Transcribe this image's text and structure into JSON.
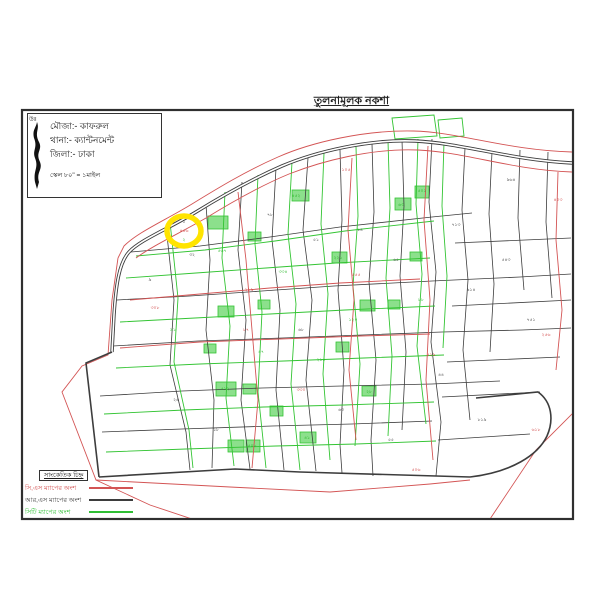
{
  "header": {
    "title": "তুলনামূলক নকশা"
  },
  "info_box": {
    "north_label": "উঃ",
    "mouza": "মৌজা:- কাফরুল",
    "thana": "থানা:- ক্যান্টনমেন্ট",
    "zila": "জিলা:- ঢাকা",
    "scale": "স্কেল ৮০\" = ১মাইল"
  },
  "legend": {
    "title": "সাংকেতিক চিহ্ন",
    "entries": [
      {
        "label": "সি,এস ম্যাপের অংশ",
        "color": "#d35454"
      },
      {
        "label": "আর,এস ম্যাপের অংশ",
        "color": "#3d3d3d"
      },
      {
        "label": "সিটি ম্যাপের অংশ",
        "color": "#2fbf35"
      }
    ]
  },
  "map": {
    "colors": {
      "frame": "#2f2f2f",
      "rs_black": "#3d3d3d",
      "cs_red": "#d35454",
      "city_green": "#33c433",
      "fill_green": "#8ce08c",
      "label_green": "#1db31d",
      "label_red": "#cc3333",
      "label_black": "#333333",
      "highlight_yellow": "#ffe400"
    },
    "frame": {
      "x": 22,
      "y": 110,
      "w": 551,
      "h": 409
    },
    "highlight": {
      "cx": 184,
      "cy": 231,
      "rx": 17,
      "ry": 15,
      "w": 5.5
    },
    "roads": [
      {
        "d": "M 572,163 C 510,160 462,143 415,141 C 368,139 315,152 282,166 C 250,180 222,196 196,212 C 168,229 140,240 129,252 C 119,263 116,285 114,315 L 112,352",
        "w": 3.4
      },
      {
        "d": "M 112,352 L 86,363 L 99,477",
        "w": 1.6
      },
      {
        "d": "M 99,477 L 235,469 L 300,472 L 470,477",
        "w": 1.6
      },
      {
        "d": "M 470,477 C 512,472 538,455 547,436 C 554,420 552,402 538,392 L 476,398",
        "w": 1.6
      }
    ],
    "rs_lines": [
      "M 166,226 L 174,300 L 170,365 L 186,432 L 190,470",
      "M 206,205 L 210,260 L 206,330 L 214,400 L 212,468",
      "M 242,182 L 238,250 L 246,320 L 241,400 L 250,469",
      "M 276,168 L 272,240 L 280,310 L 276,390 L 284,470",
      "M 308,158 L 303,230 L 312,300 L 306,380 L 316,471",
      "M 340,150 L 342,220 L 338,290 L 344,370 L 340,445 L 342,473",
      "M 372,144 L 374,212 L 369,282 L 376,360 L 371,440 L 373,476",
      "M 402,140 L 404,206 L 400,276 L 406,352 L 402,430",
      "M 432,139 L 429,202 L 436,272 L 431,342 L 441,422 L 436,476",
      "M 465,148 L 462,210 L 468,280 L 463,350 L 470,420",
      "M 492,152 L 489,214 L 494,284 L 490,352",
      "M 520,150 L 518,218 L 524,290",
      "M 548,152 L 546,222 L 552,298",
      "M 131,252 L 200,246 L 270,237 L 340,227 L 432,217 L 472,213",
      "M 117,300 L 190,296 L 262,291 L 334,286 L 432,281 L 520,277 L 571,274",
      "M 113,346 L 198,341 L 282,338 L 362,335 L 442,332 L 522,330 L 571,328",
      "M 100,396 L 182,391 L 262,388 L 342,386 L 432,384 L 500,381",
      "M 102,432 L 182,429 L 272,426 L 352,424 L 432,421",
      "M 455,243 L 571,238",
      "M 452,306 L 571,300",
      "M 447,362 L 560,357",
      "M 442,397 L 540,392",
      "M 438,440 L 530,434"
    ],
    "cs_lines": [
      "M 572,152 C 505,150 460,132 413,131 C 365,130 312,142 278,157 C 246,171 218,188 192,204 C 164,221 138,232 124,246 L 118,258",
      "M 572,172 C 512,170 465,152 418,150 C 372,148 322,161 289,174 C 260,186 232,202 206,218 C 180,233 152,246 136,258",
      "M 118,258 L 112,300 L 108,355 L 82,366 L 62,392 L 96,480 L 150,505 L 192,519",
      "M 96,480 L 230,487 L 330,492 L 430,484 L 470,480",
      "M 238,192 L 246,260 L 252,330 L 258,400 L 252,468",
      "M 352,158 L 348,230 L 354,300 L 349,370 L 356,440",
      "M 428,146 L 424,220 L 430,300 L 426,380 L 433,460",
      "M 558,172 L 556,240 L 562,310 L 556,370",
      "M 574,412 L 536,450 L 490,519",
      "M 130,300 L 200,294 L 270,288 L 340,283 L 420,279",
      "M 120,348 L 200,342 L 280,339 L 360,336 L 430,334"
    ],
    "city_lines": [
      "M 170,222 L 178,298 L 174,362 L 189,430 L 193,468",
      "M 225,192 L 222,258 L 230,326 L 226,398 L 234,466",
      "M 258,175 L 255,244 L 262,312 L 258,392 L 266,468",
      "M 292,162 L 288,234 L 296,304 L 291,384 L 300,470",
      "M 324,153 L 321,224 L 328,294 L 323,374 L 330,460",
      "M 356,147 L 358,216 L 353,286 L 360,364 L 355,446",
      "M 388,141 L 390,208 L 386,278 L 392,356 L 388,436",
      "M 418,139 L 416,204 L 422,274 L 417,346 L 426,424",
      "M 444,142 L 442,206 L 447,276 L 443,348",
      "M 136,256 L 205,250 L 275,241 L 345,231 L 434,221",
      "M 126,278 L 196,273 L 266,268 L 336,263 L 430,258",
      "M 120,322 L 195,318 L 270,314 L 345,310 L 435,306",
      "M 116,368 L 200,364 L 284,361 L 364,358 L 444,355",
      "M 104,414 L 184,410 L 264,407 L 344,405 L 434,402",
      "M 106,452 L 186,449 L 276,446 L 356,444 L 436,441",
      "M 392,118 L 434,115 L 437,136 L 395,139 Z",
      "M 438,120 L 462,118 L 464,136 L 440,138 Z"
    ],
    "green_fills": [
      [
        208,
        216,
        20,
        13
      ],
      [
        292,
        190,
        17,
        11
      ],
      [
        248,
        232,
        13,
        9
      ],
      [
        332,
        252,
        15,
        11
      ],
      [
        395,
        198,
        16,
        12
      ],
      [
        415,
        186,
        14,
        12
      ],
      [
        218,
        306,
        16,
        11
      ],
      [
        258,
        300,
        12,
        9
      ],
      [
        360,
        300,
        15,
        11
      ],
      [
        410,
        252,
        12,
        9
      ],
      [
        216,
        382,
        20,
        14
      ],
      [
        243,
        384,
        13,
        10
      ],
      [
        270,
        406,
        13,
        10
      ],
      [
        300,
        432,
        16,
        11
      ],
      [
        362,
        386,
        14,
        10
      ],
      [
        228,
        440,
        16,
        12
      ],
      [
        246,
        440,
        14,
        12
      ],
      [
        388,
        300,
        12,
        9
      ],
      [
        336,
        342,
        13,
        10
      ],
      [
        204,
        344,
        12,
        9
      ]
    ],
    "labels": [
      [
        150,
        281,
        "৯",
        "k"
      ],
      [
        192,
        256,
        "৩২",
        "k"
      ],
      [
        270,
        216,
        "৭৮",
        "k"
      ],
      [
        316,
        241,
        "৫১",
        "k"
      ],
      [
        360,
        231,
        "১৪",
        "k"
      ],
      [
        396,
        261,
        "৬৫",
        "k"
      ],
      [
        456,
        226,
        "৭১৩",
        "k"
      ],
      [
        471,
        291,
        "৯১৪",
        "k"
      ],
      [
        506,
        261,
        "৫৪৩",
        "k"
      ],
      [
        531,
        321,
        "৭৫১",
        "k"
      ],
      [
        482,
        421,
        "৮১৯",
        "k"
      ],
      [
        341,
        411,
        "৬৩",
        "k"
      ],
      [
        216,
        431,
        "১৮",
        "k"
      ],
      [
        176,
        401,
        "২৬",
        "k"
      ],
      [
        441,
        376,
        "৪৪",
        "k"
      ],
      [
        511,
        181,
        "৯৬৪",
        "k"
      ],
      [
        391,
        441,
        "৫৫",
        "k"
      ],
      [
        301,
        331,
        "৬৮",
        "k"
      ],
      [
        184,
        223,
        "১",
        "k"
      ],
      [
        222,
        252,
        "৫৬৭",
        "g"
      ],
      [
        296,
        197,
        "৪৫২",
        "g"
      ],
      [
        338,
        259,
        "২২১",
        "g"
      ],
      [
        401,
        206,
        "৬৩",
        "g"
      ],
      [
        225,
        390,
        "৫১২",
        "g"
      ],
      [
        307,
        439,
        "৪১",
        "g"
      ],
      [
        369,
        393,
        "২৮",
        "g"
      ],
      [
        252,
        447,
        "৫০৮",
        "g"
      ],
      [
        173,
        331,
        "৯১",
        "g"
      ],
      [
        283,
        273,
        "৩৩৪",
        "g"
      ],
      [
        353,
        321,
        "১২০",
        "g"
      ],
      [
        421,
        301,
        "৮৮",
        "g"
      ],
      [
        261,
        353,
        "৪৭",
        "g"
      ],
      [
        321,
        361,
        "২১৫",
        "g"
      ],
      [
        184,
        241,
        "২",
        "g"
      ],
      [
        422,
        192,
        "৫০১",
        "g"
      ],
      [
        184,
        232,
        "৪৫৬",
        "r"
      ],
      [
        155,
        309,
        "৩০৮",
        "r"
      ],
      [
        249,
        291,
        "২১৯",
        "r"
      ],
      [
        356,
        276,
        "৫৫৫",
        "r"
      ],
      [
        301,
        391,
        "৩৩০",
        "r"
      ],
      [
        431,
        356,
        "৫২৯",
        "r"
      ],
      [
        546,
        336,
        "২৫৬",
        "r"
      ],
      [
        558,
        201,
        "৪০৩",
        "r"
      ],
      [
        416,
        471,
        "৫০৬",
        "r"
      ],
      [
        346,
        171,
        "১০৫",
        "r"
      ],
      [
        536,
        431,
        "৬১৮",
        "r"
      ],
      [
        246,
        331,
        "৮৭",
        "r"
      ]
    ]
  }
}
